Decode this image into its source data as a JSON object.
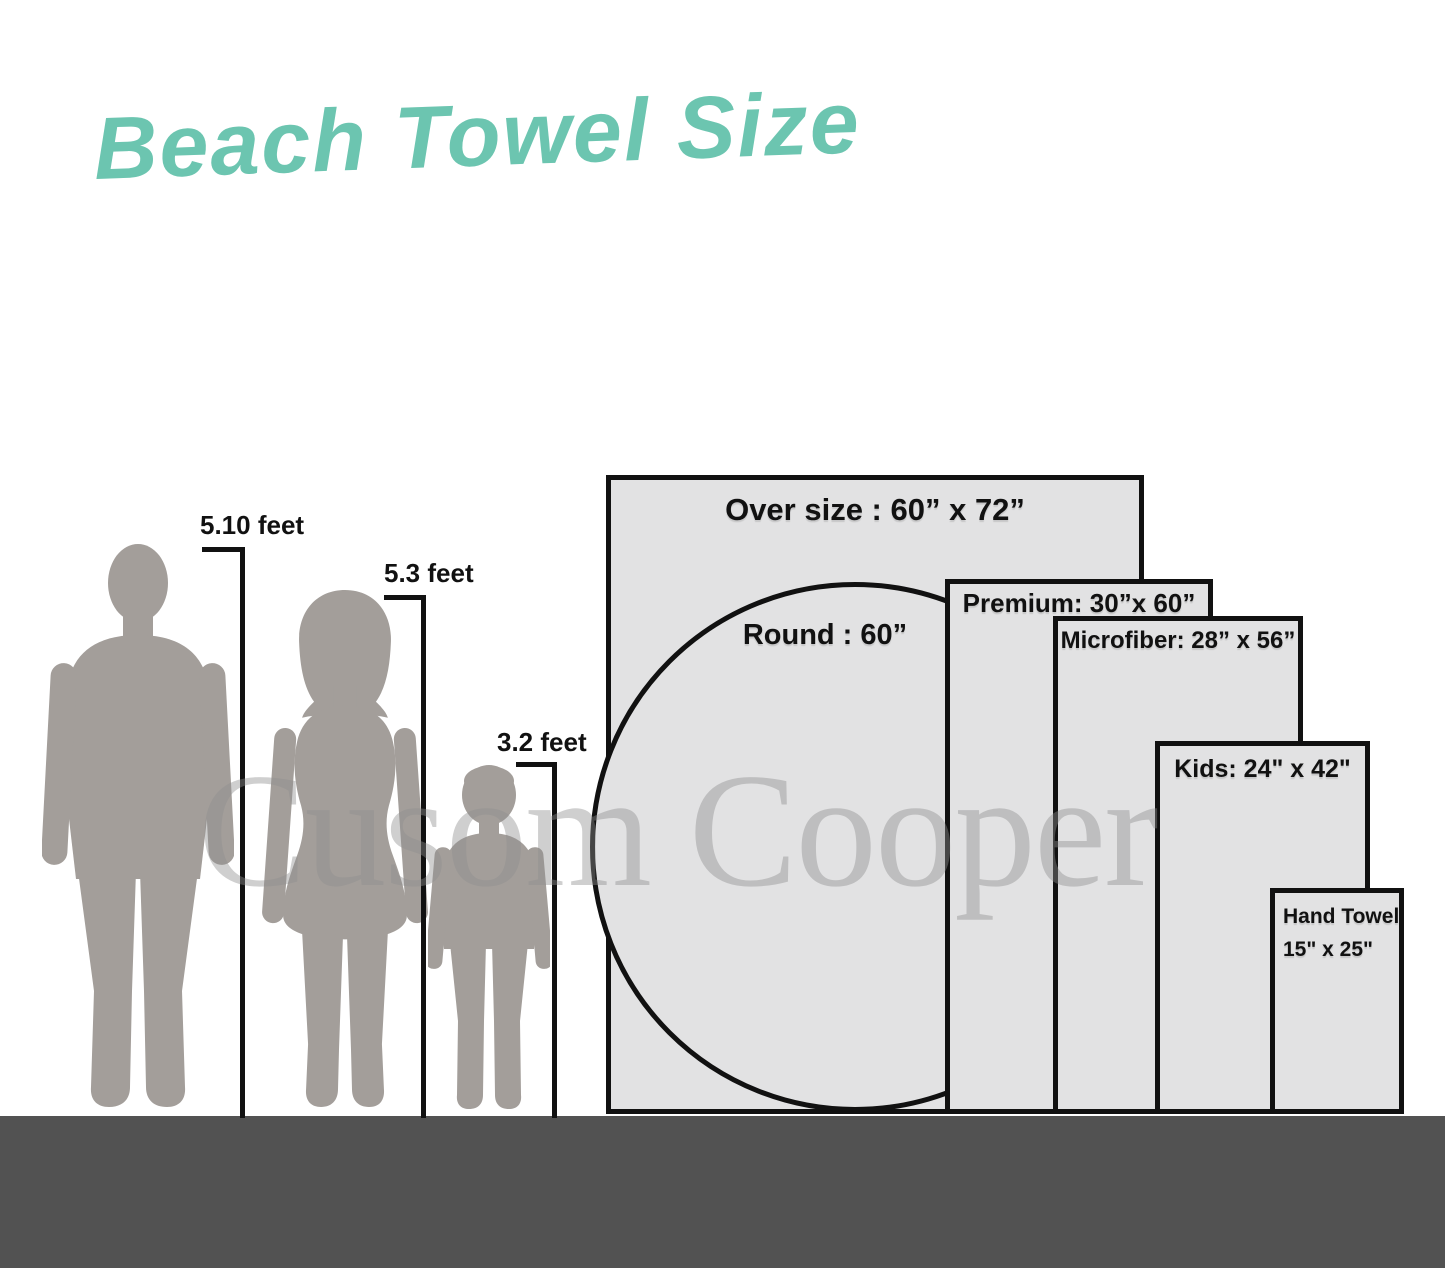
{
  "title": "Beach Towel Size",
  "watermark": "Cusom Cooper",
  "people": [
    {
      "id": "man",
      "height_label": "5.10 feet"
    },
    {
      "id": "woman",
      "height_label": "5.3 feet"
    },
    {
      "id": "child",
      "height_label": "3.2 feet"
    }
  ],
  "towels": [
    {
      "id": "oversize",
      "shape": "rect",
      "label": "Over size : 60” x 72”",
      "width_in": 60,
      "height_in": 72
    },
    {
      "id": "round",
      "shape": "circle",
      "label": "Round : 60”",
      "diameter_in": 60
    },
    {
      "id": "premium",
      "shape": "rect",
      "label": "Premium: 30”x 60”",
      "width_in": 30,
      "height_in": 60
    },
    {
      "id": "microfiber",
      "shape": "rect",
      "label": "Microfiber: 28” x 56”",
      "width_in": 28,
      "height_in": 56
    },
    {
      "id": "kids",
      "shape": "rect",
      "label": "Kids: 24\" x 42\"",
      "width_in": 24,
      "height_in": 42
    },
    {
      "id": "hand",
      "shape": "rect",
      "label_line1": "Hand Towel",
      "label_line2": "15\" x 25\"",
      "width_in": 15,
      "height_in": 25
    }
  ],
  "colors": {
    "title_teal": "#6cc5b0",
    "towel_fill": "#e2e2e3",
    "outline_black": "#111111",
    "silhouette_gray": "#a39e9a",
    "ground_gray": "#525252",
    "watermark_gray": "#8f8f8f"
  }
}
